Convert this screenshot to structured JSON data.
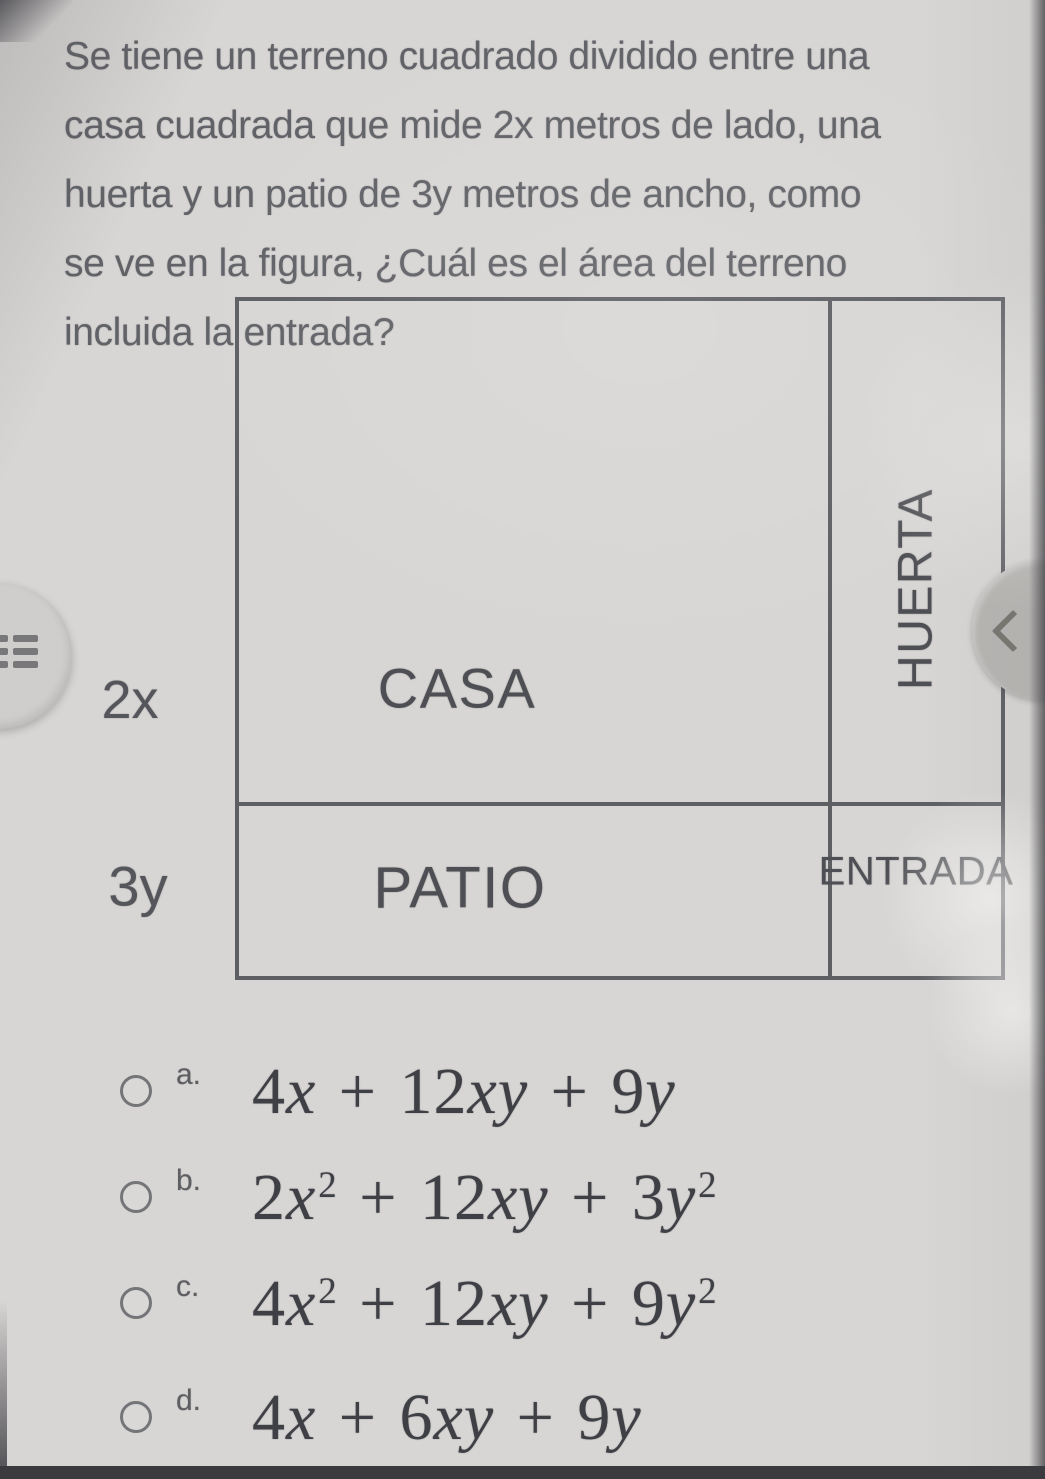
{
  "question": {
    "lines": [
      "Se tiene un terreno cuadrado dividido entre una",
      "casa cuadrada que mide 2x metros de lado, una",
      "huerta y un patio de 3y metros de ancho, como",
      "se ve en la figura, ¿Cuál es el área del terreno",
      "incluida la entrada?"
    ]
  },
  "figure": {
    "regions": {
      "casa": "CASA",
      "huerta": "HUERTA",
      "patio": "PATIO",
      "entrada": "ENTRADA"
    },
    "dimensions": {
      "casa_side": "2x",
      "patio_width": "3y"
    }
  },
  "nav": {
    "menu_icon": "bulleted-list-menu-icon",
    "back_icon": "chevron-left-icon"
  },
  "options": [
    {
      "key": "a.",
      "text": "4x + 12xy + 9y",
      "parts": [
        {
          "t": "4"
        },
        {
          "t": "x",
          "i": 1
        },
        {
          "t": " + 12"
        },
        {
          "t": "xy",
          "i": 1
        },
        {
          "t": " + 9"
        },
        {
          "t": "y",
          "i": 1
        }
      ]
    },
    {
      "key": "b.",
      "text": "2x² + 12xy + 3y²",
      "parts": [
        {
          "t": "2"
        },
        {
          "t": "x",
          "i": 1
        },
        {
          "t": "2",
          "sup": 1
        },
        {
          "t": " + 12"
        },
        {
          "t": "xy",
          "i": 1
        },
        {
          "t": " + 3"
        },
        {
          "t": "y",
          "i": 1
        },
        {
          "t": "2",
          "sup": 1
        }
      ]
    },
    {
      "key": "c.",
      "text": "4x² + 12xy + 9y²",
      "parts": [
        {
          "t": "4"
        },
        {
          "t": "x",
          "i": 1
        },
        {
          "t": "2",
          "sup": 1
        },
        {
          "t": " + 12"
        },
        {
          "t": "xy",
          "i": 1
        },
        {
          "t": " + 9"
        },
        {
          "t": "y",
          "i": 1
        },
        {
          "t": "2",
          "sup": 1
        }
      ]
    },
    {
      "key": "d.",
      "text": "4x + 6xy + 9y",
      "parts": [
        {
          "t": "4"
        },
        {
          "t": "x",
          "i": 1
        },
        {
          "t": " + 6"
        },
        {
          "t": "xy",
          "i": 1
        },
        {
          "t": " + 9"
        },
        {
          "t": "y",
          "i": 1
        }
      ]
    }
  ],
  "colors": {
    "background": "#d8d6d4",
    "question_text": "#616267",
    "figure_lines": "#5e5f63",
    "figure_labels": "#4e4f54",
    "formula_text": "#3f4046",
    "radio_border": "#747579",
    "left_tab": "#d0cecc",
    "right_tab": "#b7b5b2",
    "screen_edge_dark": "#3b3a3e"
  }
}
